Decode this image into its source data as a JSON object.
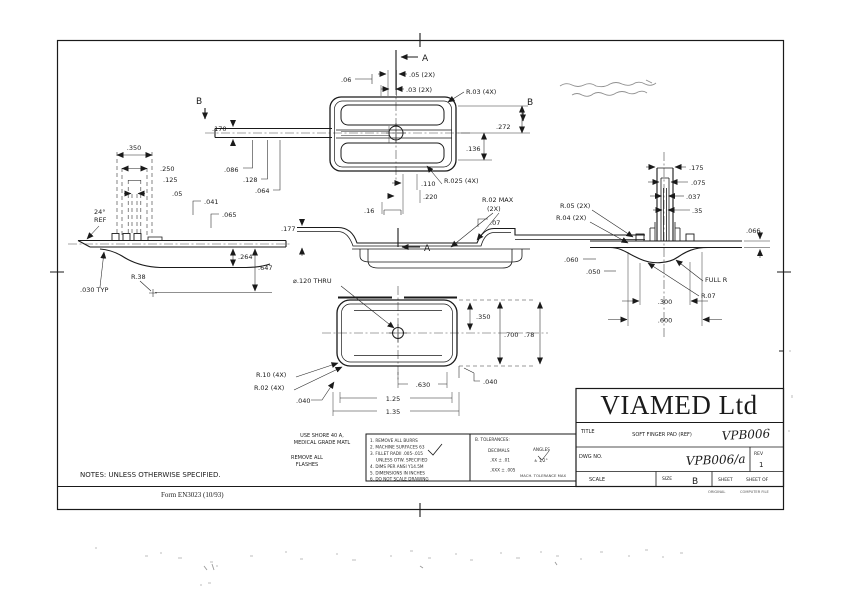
{
  "colors": {
    "ink": "#1a1a1a",
    "paper": "#ffffff",
    "pencil": "#8f8f8f"
  },
  "section_markers": {
    "a": "A",
    "b": "B"
  },
  "dims": {
    "top": {
      "d05": ".05 (2X)",
      "d03": ".03 (2X)",
      "d06": ".06",
      "r03": "R.03 (4X)",
      "d272": ".272",
      "d136": ".136",
      "d170": ".170",
      "d086": ".086",
      "d128": ".128",
      "d064": ".064"
    },
    "section": {
      "d177": ".177",
      "d110": ".110",
      "d220": ".220",
      "d16": ".16",
      "r025": "R.025 (4X)",
      "r02max": "R.02 MAX",
      "r02max2": "(2X)",
      "d07": ".07"
    },
    "left": {
      "d350": ".350",
      "d250": ".250",
      "d125": ".125",
      "d05": ".05",
      "d041": ".041",
      "d065": ".065",
      "ang": "24°",
      "ref": "REF",
      "r38": "R.38",
      "d264": ".264",
      "d647": ".647",
      "d030": ".030 TYP"
    },
    "bottom": {
      "hole": "⌀.120 THRU",
      "d350": ".350",
      "d700": ".700",
      "d78": ".78",
      "d040r": ".040",
      "d630": ".630",
      "d125": "1.25",
      "d135": "1.35",
      "r10": "R.10 (4X)",
      "r02": "R.02 (4X)",
      "d040l": ".040"
    },
    "right": {
      "d175": ".175",
      "d075": ".075",
      "d037": ".037",
      "d35": ".35",
      "r05": "R.05 (2X)",
      "r04": "R.04 (2X)",
      "d066": ".066",
      "d060": ".060",
      "d050": ".050",
      "fullr": "FULL R",
      "r07": "R.07",
      "d300": ".300",
      "d600": ".600"
    }
  },
  "notes": {
    "material_1": "USE SHORE 40 A,",
    "material_2": "MEDICAL GRADE MATL",
    "flash_1": "REMOVE ALL",
    "flash_2": "FLASHES",
    "general": "NOTES: UNLESS OTHERWISE SPECIFIED.",
    "form_number": "Form EN3023 (10/93)"
  },
  "tolerance_block": {
    "left_lines": [
      "1. REMOVE ALL BURRS",
      "2. MACHINE SURFACES 63",
      "3. FILLET RADII .005-.015",
      "UNLESS OTW. SPECIFIED",
      "4. DIMS PER ANSI Y14.5M",
      "5. DIMENSIONS IN INCHES",
      "6. DO NOT SCALE DRAWING"
    ],
    "right_header": "B. TOLERANCES:",
    "right_col1": "DECIMALS",
    "right_col2": "ANGLES",
    "right_l1a": ".XX  ± .01",
    "right_l1b": "± 1/2°",
    "right_l2a": ".XXX ± .005",
    "right_side": "MACH. TOLERANCE MAX"
  },
  "title_block": {
    "company": "VIAMED Ltd",
    "title_label": "TITLE",
    "title_text": "SOFT FINGER PAD (REF)",
    "title_handwritten": "VPB006",
    "dwg_label": "DWG NO.",
    "dwg_value": "VPB006/a",
    "rev_label": "REV",
    "rev_value": "1",
    "scale_label": "SCALE",
    "size_label": "SIZE",
    "size_value": "B",
    "sheet_label": "SHEET",
    "sheet_of_label": "SHEET OF",
    "stamp_left": "ORIGINAL",
    "stamp_right": "COMPUTER FILE"
  }
}
